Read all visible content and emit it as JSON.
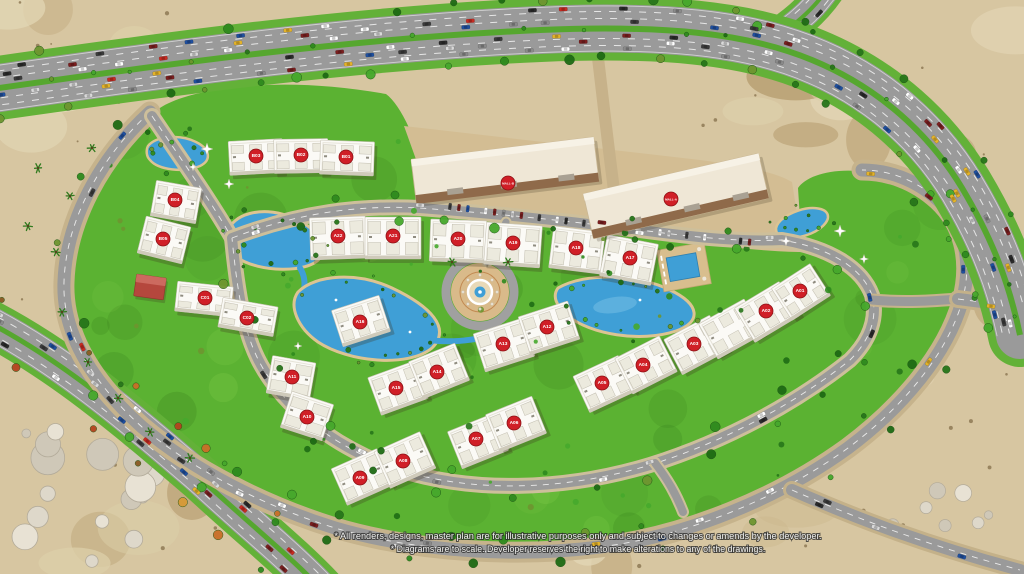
{
  "map": {
    "kind": "residential-compound-master-plan",
    "markers": [
      {
        "label": "B03",
        "x": 256,
        "y": 156
      },
      {
        "label": "B02",
        "x": 301,
        "y": 155
      },
      {
        "label": "B01",
        "x": 346,
        "y": 157
      },
      {
        "label": "B04",
        "x": 175,
        "y": 200
      },
      {
        "label": "B05",
        "x": 163,
        "y": 239
      },
      {
        "label": "C01",
        "x": 205,
        "y": 298
      },
      {
        "label": "C02",
        "x": 247,
        "y": 318
      },
      {
        "label": "MALL-B",
        "x": 508,
        "y": 183
      },
      {
        "label": "MALL-A",
        "x": 671,
        "y": 199
      },
      {
        "label": "A22",
        "x": 338,
        "y": 236
      },
      {
        "label": "A21",
        "x": 393,
        "y": 236
      },
      {
        "label": "A20",
        "x": 458,
        "y": 239
      },
      {
        "label": "A19",
        "x": 513,
        "y": 243
      },
      {
        "label": "A18",
        "x": 576,
        "y": 248
      },
      {
        "label": "A17",
        "x": 630,
        "y": 258
      },
      {
        "label": "A16",
        "x": 360,
        "y": 322
      },
      {
        "label": "A15",
        "x": 396,
        "y": 388
      },
      {
        "label": "A14",
        "x": 437,
        "y": 372
      },
      {
        "label": "A13",
        "x": 503,
        "y": 344
      },
      {
        "label": "A12",
        "x": 547,
        "y": 327
      },
      {
        "label": "A11",
        "x": 292,
        "y": 377
      },
      {
        "label": "A10",
        "x": 307,
        "y": 417
      },
      {
        "label": "A09",
        "x": 360,
        "y": 478
      },
      {
        "label": "A08",
        "x": 403,
        "y": 461
      },
      {
        "label": "A07",
        "x": 476,
        "y": 439
      },
      {
        "label": "A06",
        "x": 514,
        "y": 423
      },
      {
        "label": "A05",
        "x": 602,
        "y": 383
      },
      {
        "label": "A04",
        "x": 643,
        "y": 365
      },
      {
        "label": "A03",
        "x": 694,
        "y": 344
      },
      {
        "label": "A02",
        "x": 766,
        "y": 311
      },
      {
        "label": "A01",
        "x": 800,
        "y": 291
      }
    ],
    "disclaimer": {
      "line1": "* All renders, designs, master plan are for illustrative purposes only and subject to changes or amends by the developer.",
      "line2": "* Diagrams are to scale. Developer reserves the right to make alterations to any of the drawings."
    }
  },
  "colors": {
    "marker_red": "#d01f27",
    "grass": "#5bb232",
    "water": "#3f9fd6",
    "road": "#9a9a9a",
    "sand": "#d7c6a1",
    "mall_pad": "#d3bd93"
  }
}
